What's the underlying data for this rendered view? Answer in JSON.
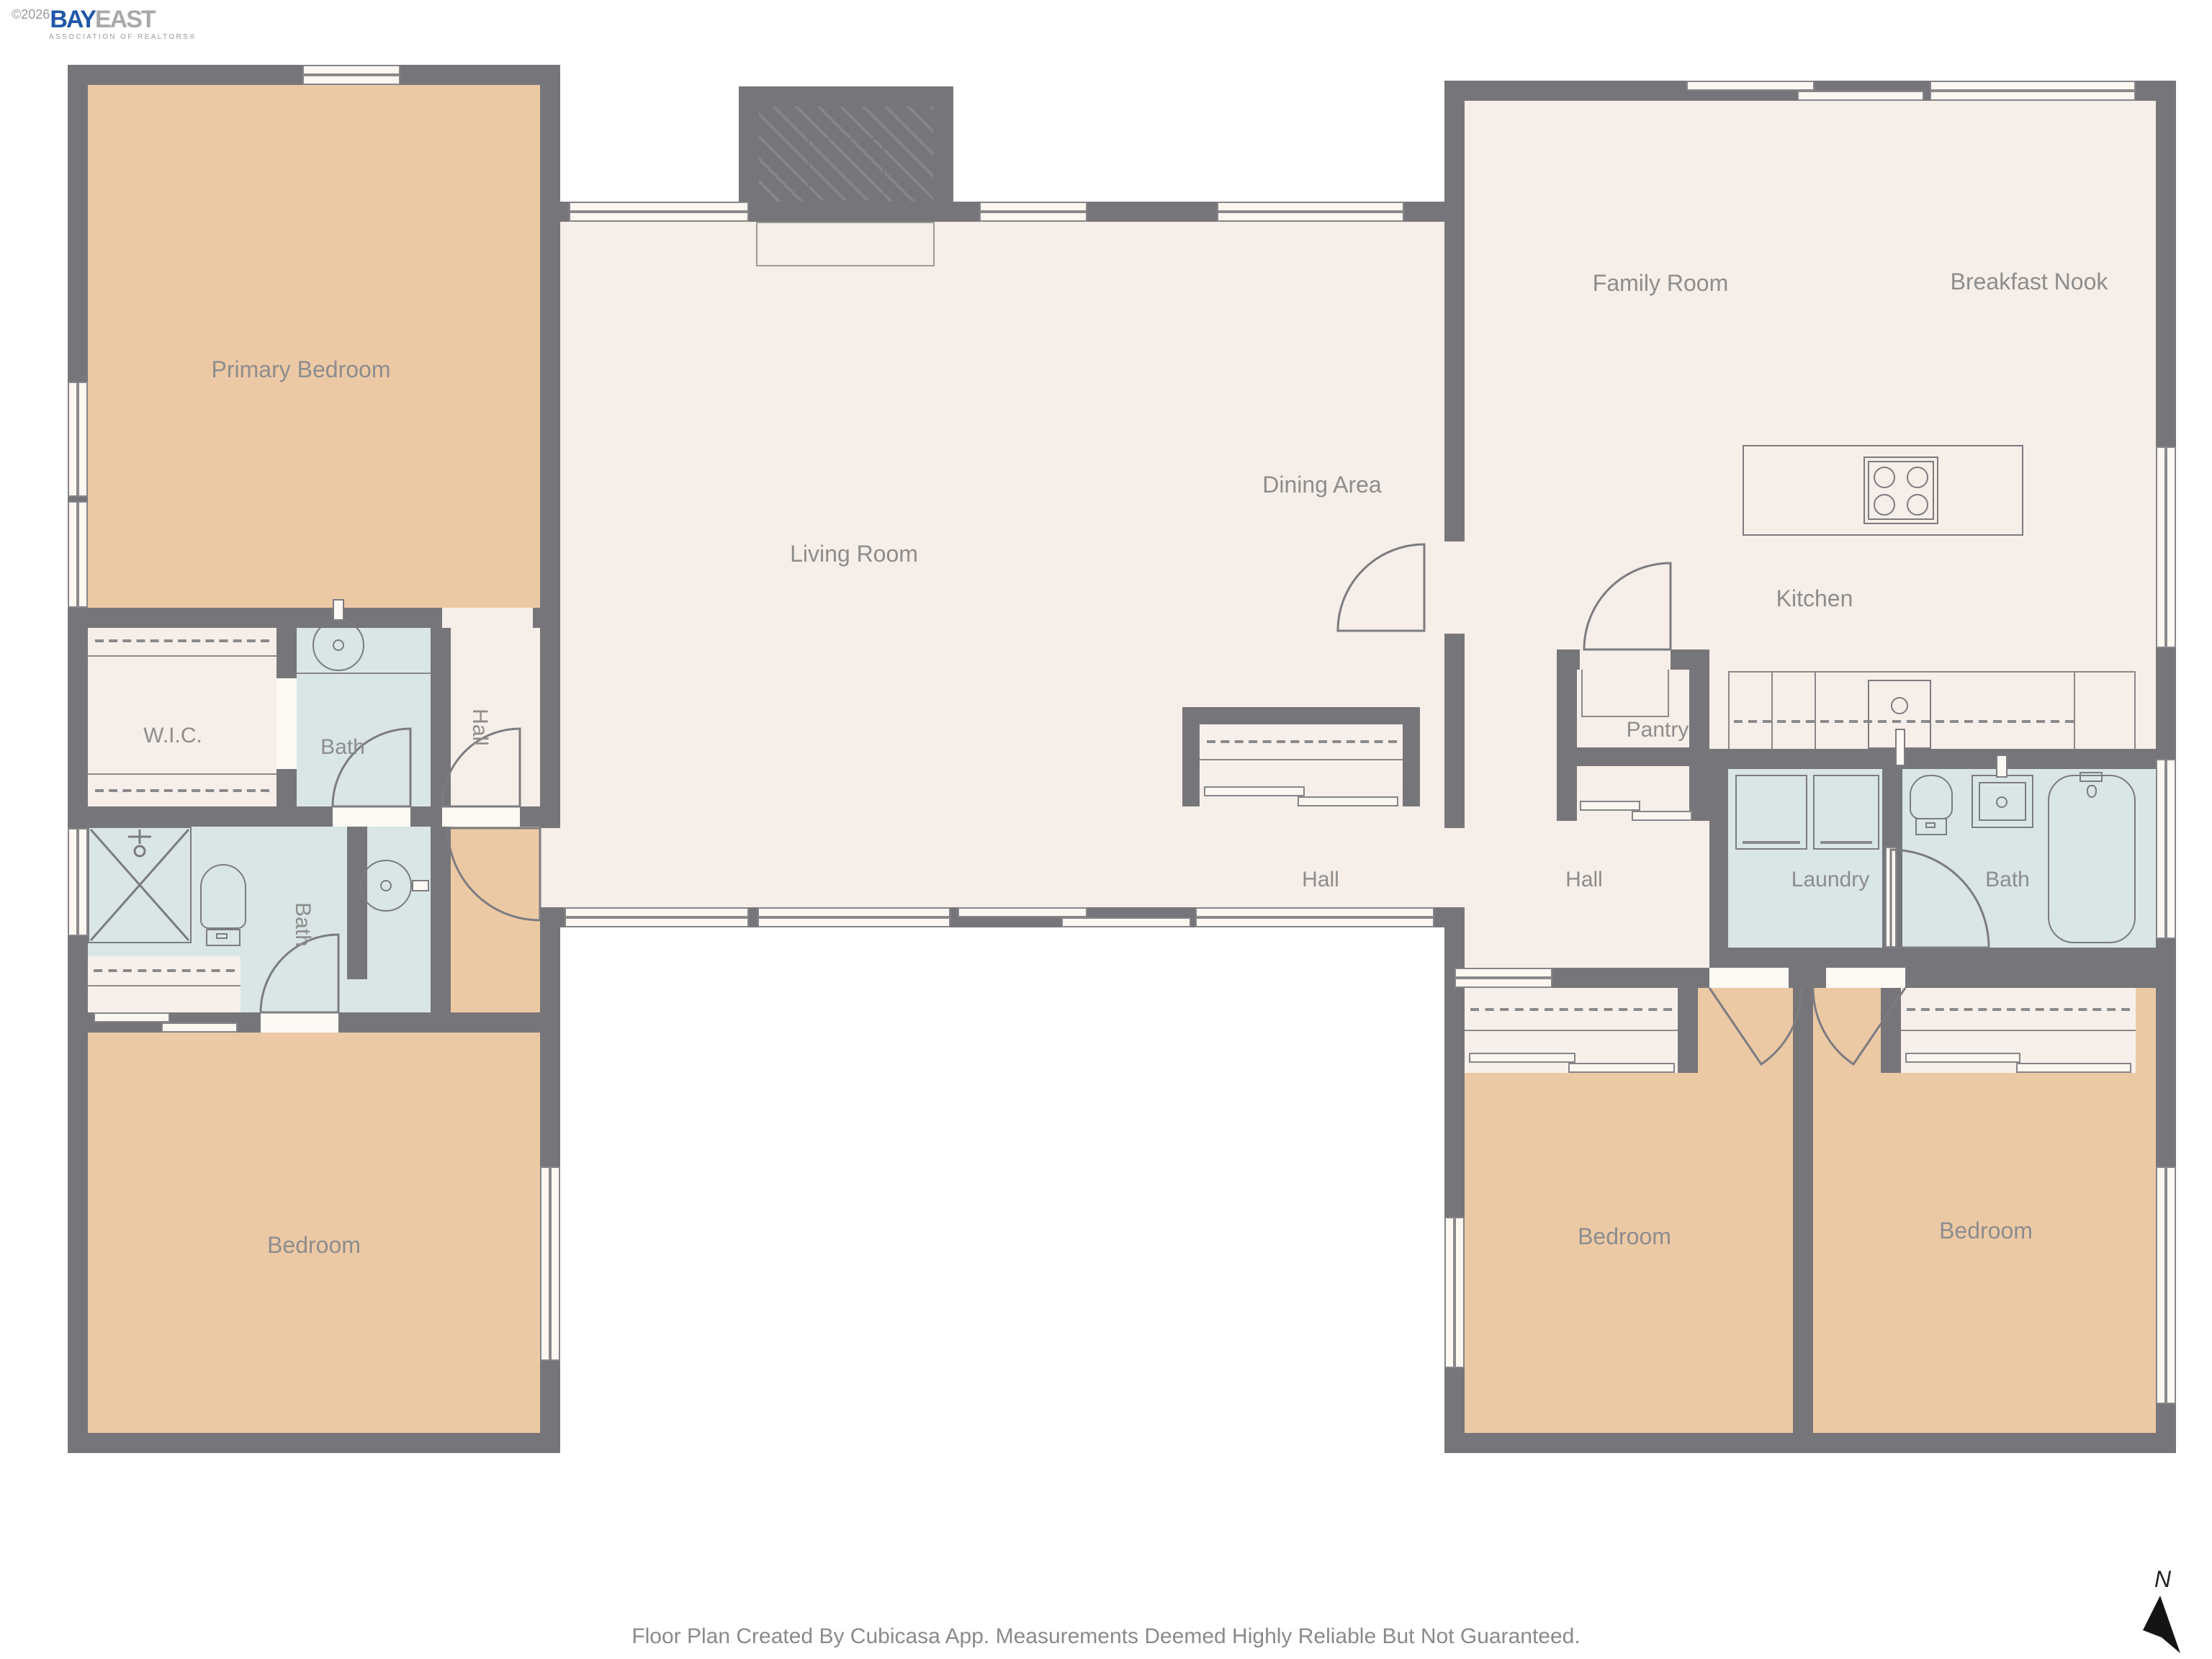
{
  "logo": {
    "copyright": "©2026",
    "brand_blue": "BAY",
    "brand_gray": "EAST",
    "subtitle": "ASSOCIATION OF REALTORS®"
  },
  "rooms": {
    "primary_bedroom": "Primary Bedroom",
    "wic": "W.I.C.",
    "bath_left_top": "Bath",
    "hall_left": "Hall",
    "bath_left_lower": "Bath",
    "bedroom_left": "Bedroom",
    "living_room": "Living Room",
    "dining_area": "Dining Area",
    "hall_center": "Hall",
    "family_room": "Family Room",
    "breakfast_nook": "Breakfast Nook",
    "kitchen": "Kitchen",
    "pantry": "Pantry",
    "hall_right": "Hall",
    "laundry": "Laundry",
    "bath_right": "Bath",
    "bedroom_middle": "Bedroom",
    "bedroom_right": "Bedroom"
  },
  "footer": "Floor Plan Created By Cubicasa App. Measurements Deemed Highly Reliable But Not Guaranteed.",
  "compass": {
    "label": "N"
  },
  "colors": {
    "wall": "#76767a",
    "floor_common": "#f6eee8",
    "floor_bedroom": "#ecc9a5",
    "floor_bath": "#d9e6e5",
    "label_text": "#8d8d8d",
    "logo_blue": "#2057a7"
  }
}
